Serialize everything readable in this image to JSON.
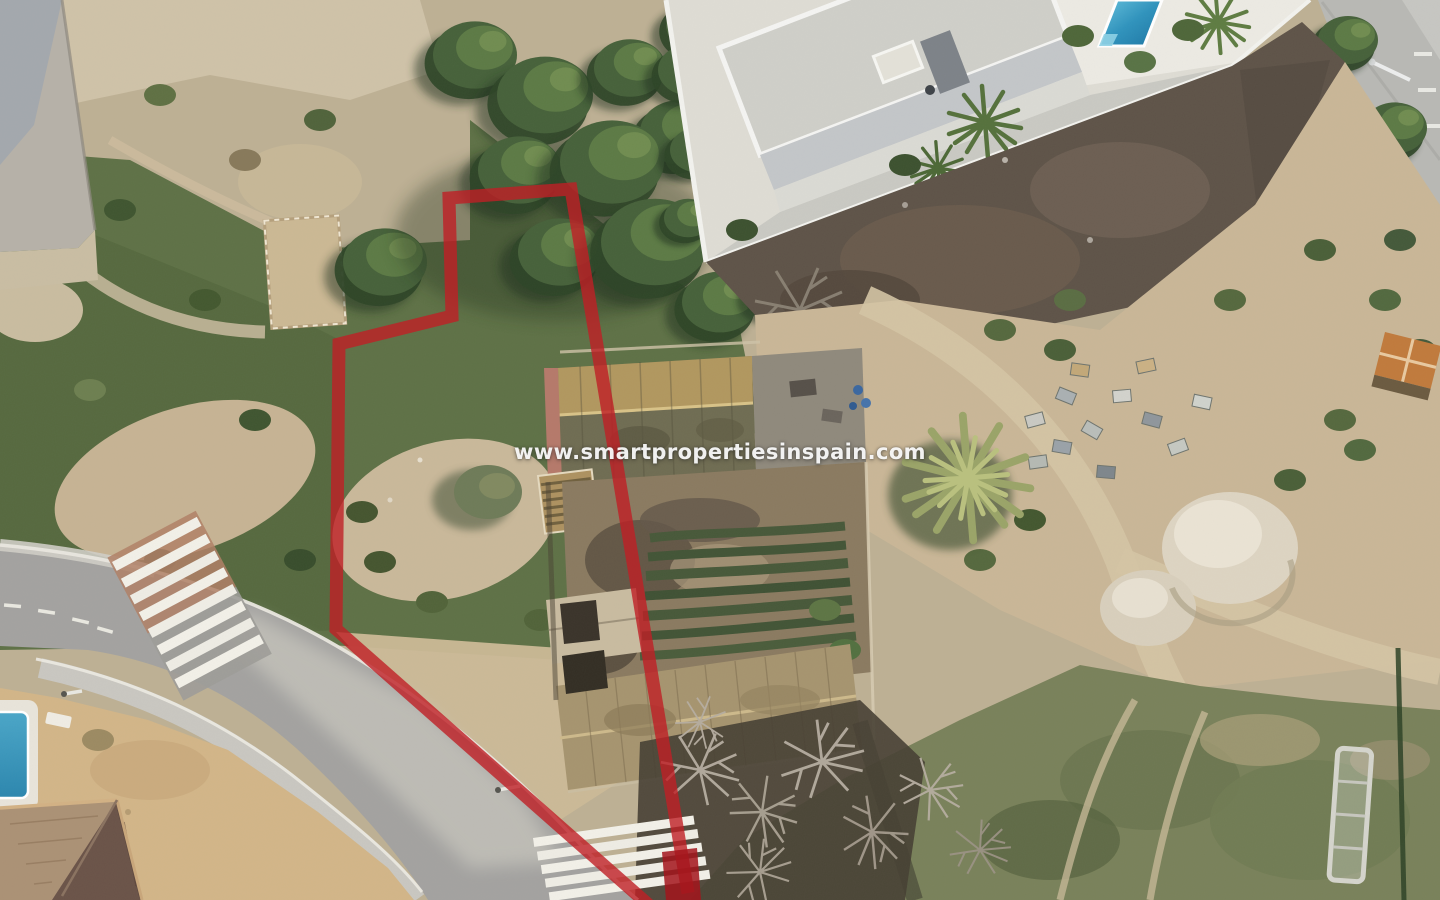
{
  "meta": {
    "width": 1440,
    "height": 900,
    "kind": "aerial-drone-photo"
  },
  "watermark": {
    "text": "www.smartpropertiesinspain.com",
    "color": "#ffffff",
    "opacity": 0.92
  },
  "boundary": {
    "color": "#bf1f26",
    "end_color": "#a3151c",
    "opacity": 0.8,
    "stroke_width": 13,
    "main_points": "650,906 336,629 339,344 452,316 449,198 571,189 688,893",
    "end_marker_points": "662,852 697,848 701,900 666,900"
  },
  "palette": {
    "scrub_green": "#5e7146",
    "pine_green": "#46613a",
    "sand": "#c9b897",
    "dirt_dark": "#5e5348",
    "road_asphalt": "#a3a2a0",
    "concrete": "#c6c4bc",
    "villa_white": "#eceae3",
    "pool_blue": "#2b86ae",
    "farm_roof_ochre": "#b1975f",
    "farm_roof_lower": "#a6946f",
    "house_roof_dark": "#6a5348",
    "field_olive": "#79815a",
    "red_overlay": "#bf1f26"
  },
  "features": [
    {
      "name": "plot-boundary-overlay",
      "label": "red plot outline"
    },
    {
      "name": "watermark-text",
      "label": "agency watermark"
    },
    {
      "name": "villa-compound",
      "label": "modern white villa with pool"
    },
    {
      "name": "farmhouse-ruin",
      "label": "old farmhouse with tiled roofs and courtyard garden"
    },
    {
      "name": "road",
      "label": "curved street with two zebra crossings"
    },
    {
      "name": "neighbor-house",
      "label": "corner house with hip roof and small pool"
    },
    {
      "name": "palm-tree",
      "label": "large palm"
    },
    {
      "name": "pine-trees",
      "label": "pine tree cluster"
    },
    {
      "name": "scrubland",
      "label": "green scrub"
    },
    {
      "name": "dirt-area",
      "label": "bare earth"
    },
    {
      "name": "gravel-mounds",
      "label": "white aggregate mounds"
    },
    {
      "name": "junk-pallets",
      "label": "stored pallets and crates"
    }
  ]
}
